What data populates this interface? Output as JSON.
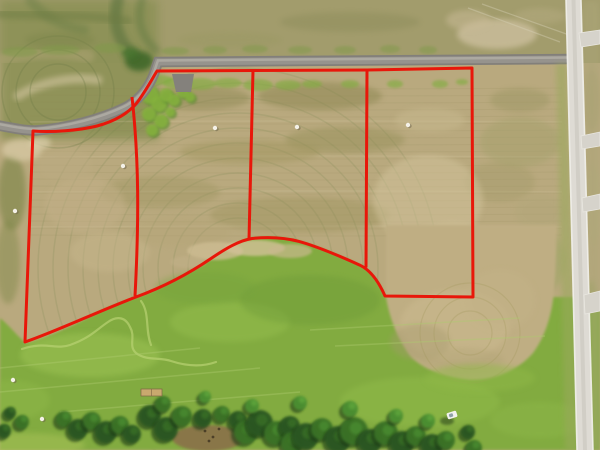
{
  "scene": {
    "type": "aerial-drone-photo",
    "subject": "farmland with four surveyed lots outlined in red, paved road at top, gravel road at right, pasture and tree line below"
  },
  "palette": {
    "field_tan": "#b9a97e",
    "top_strip_olive": "#a29c6c",
    "upper_left_green": "#8c9156",
    "pasture_green": "#82ab40",
    "lobe_tan": "#bfae83",
    "asphalt": "#827f7a",
    "asphalt_mid": "#96938d",
    "asphalt_hi": "#b0ada5",
    "gravel_road": "#dedbd4",
    "gravel_edge": "#f2f1ec",
    "boundary_red": "#e8170a",
    "tree_shadow": "#1b3a15",
    "dirt_brown": "#8a7148"
  },
  "geometry": {
    "base": {
      "w": 600,
      "h": 450,
      "top_strip_h": 63,
      "upper_left": [
        0,
        0,
        158,
        140
      ]
    },
    "pasture_path": "M0,318 C10,326 18,337 26,343 C46,339 82,321 103,310 C121,302 128,300 137,297 C160,289 187,274 209,260 C223,250 236,241 251,238 C268,236 286,237 299,241 C317,246 341,256 360,265 C372,271 380,284 386,297 L600,297 L600,450 L0,450 Z",
    "lobe_path": "M386,297 C389,316 397,339 411,357 C425,370 447,378 470,380 C496,380 518,370 533,353 C545,337 552,315 554,291 C556,268 556,248 557,232 L557,225 L386,225 Z",
    "striations": {
      "y0": 88,
      "y1": 236,
      "step": 7,
      "x0": 30,
      "x1": 562,
      "color": "#8a8157",
      "opacity": 0.13,
      "light_ys": [
        122,
        157,
        192,
        227
      ],
      "light_color": "#d8caa2",
      "light_opacity": 0.22
    },
    "rings": [
      {
        "cx": 238,
        "cy": 268,
        "radii": [
          50,
          65,
          80,
          95,
          110,
          125,
          140,
          155,
          170,
          185,
          200
        ],
        "color": "#77854b",
        "opacity": 0.18
      },
      {
        "cx": 58,
        "cy": 92,
        "radii": [
          28,
          42,
          56
        ],
        "color": "#6d7c46",
        "opacity": 0.3
      },
      {
        "cx": 470,
        "cy": 333,
        "radii": [
          22,
          36,
          50
        ],
        "color": "#a3975c",
        "opacity": 0.3,
        "late": true
      }
    ],
    "ul_strokes": [
      [
        "M118,0 C112,22 118,42 134,55",
        12,
        "#55703a",
        0.55
      ],
      [
        "M142,0 C136,20 142,38 156,50",
        8,
        "#5e7840",
        0.45
      ],
      [
        "M30,0 C45,18 62,26 84,30",
        10,
        "#647a42",
        0.38
      ],
      [
        "M18,96 C40,82 72,76 98,80",
        9,
        "#cfc29b",
        0.65
      ],
      [
        "M0,14 C40,15 92,15 128,21",
        9,
        "#6d7c42",
        0.5
      ],
      [
        "M0,60 C28,52 60,50 88,56",
        13,
        "#b0a476",
        0.5
      ]
    ],
    "field_mottles": [
      [
        200,
        98,
        50,
        12,
        "#8f8a55",
        0.5
      ],
      [
        320,
        96,
        62,
        14,
        "#8a8550",
        0.5
      ],
      [
        345,
        140,
        60,
        13,
        "#938e56",
        0.45
      ],
      [
        250,
        152,
        70,
        12,
        "#9a9157",
        0.38
      ],
      [
        160,
        192,
        60,
        16,
        "#9c945e",
        0.4
      ],
      [
        300,
        215,
        90,
        18,
        "#958e55",
        0.35
      ],
      [
        520,
        100,
        30,
        12,
        "#9a9562",
        0.45
      ],
      [
        500,
        182,
        35,
        20,
        "#a29a68",
        0.4
      ],
      [
        430,
        120,
        35,
        12,
        "#c8b98f",
        0.5
      ],
      [
        85,
        205,
        40,
        28,
        "#c3b088",
        0.5
      ],
      [
        65,
        165,
        28,
        16,
        "#bcab82",
        0.5
      ],
      [
        110,
        252,
        40,
        20,
        "#c8b78d",
        0.45
      ],
      [
        180,
        232,
        50,
        15,
        "#b4a476",
        0.35
      ],
      [
        428,
        200,
        55,
        45,
        "#d3c49c",
        0.5
      ],
      [
        452,
        252,
        45,
        30,
        "#cfc098",
        0.5
      ],
      [
        540,
        212,
        25,
        18,
        "#b0a678",
        0.4
      ],
      [
        520,
        142,
        40,
        25,
        "#a3a06a",
        0.45
      ],
      [
        545,
        262,
        20,
        30,
        "#9aa562",
        0.45
      ],
      [
        12,
        192,
        14,
        38,
        "#73803f",
        0.55
      ],
      [
        8,
        262,
        12,
        42,
        "#7d8746",
        0.45
      ],
      [
        22,
        150,
        20,
        11,
        "#d6c8a2",
        0.8
      ],
      [
        40,
        143,
        11,
        6,
        "#dcd0ac",
        0.7
      ],
      [
        497,
        34,
        40,
        15,
        "#cfc1a0",
        0.75
      ],
      [
        468,
        20,
        22,
        10,
        "#c8b995",
        0.55
      ],
      [
        540,
        16,
        26,
        8,
        "#b5ab80",
        0.5
      ],
      [
        350,
        22,
        70,
        10,
        "#8a8a58",
        0.4
      ],
      [
        230,
        40,
        52,
        8,
        "#989860",
        0.35
      ],
      [
        60,
        40,
        35,
        8,
        "#7a8448",
        0.4
      ],
      [
        592,
        20,
        8,
        18,
        "#a8a271",
        0.55
      ],
      [
        592,
        100,
        8,
        30,
        "#a8a06e",
        0.5
      ],
      [
        594,
        205,
        8,
        40,
        "#b3ab7c",
        0.5
      ],
      [
        591,
        330,
        8,
        50,
        "#8fa055",
        0.5
      ],
      [
        592,
        420,
        8,
        26,
        "#7fa84a",
        0.55
      ],
      [
        139,
        61,
        14,
        10,
        "#3a6527",
        0.85
      ],
      [
        130,
        53,
        8,
        6,
        "#47742e",
        0.8
      ]
    ],
    "bushes": {
      "color": "#86b23d",
      "under": "#5d8c33",
      "blobs": [
        [
          150,
          95,
          9
        ],
        [
          159,
          104,
          8
        ],
        [
          149,
          114,
          7
        ],
        [
          161,
          121,
          7
        ],
        [
          152,
          130,
          6
        ],
        [
          166,
          95,
          7
        ],
        [
          174,
          100,
          6
        ],
        [
          183,
          92,
          6
        ],
        [
          170,
          112,
          5
        ],
        [
          190,
          97,
          5
        ]
      ]
    },
    "strip_under_road": {
      "color": "#83ad42",
      "opacity": 0.65,
      "blobs": [
        [
          160,
          80,
          12,
          5
        ],
        [
          178,
          83,
          15,
          6
        ],
        [
          200,
          84,
          16,
          6
        ],
        [
          228,
          83,
          14,
          5
        ],
        [
          258,
          85,
          15,
          6
        ],
        [
          288,
          85,
          13,
          5
        ],
        [
          312,
          84,
          10,
          4
        ],
        [
          350,
          84,
          9,
          4
        ],
        [
          395,
          84,
          8,
          4
        ],
        [
          440,
          84,
          8,
          4
        ],
        [
          462,
          82,
          6,
          3
        ]
      ]
    },
    "strip_above_road": {
      "color": "#7f9a4a",
      "opacity": 0.5,
      "blobs": [
        [
          20,
          52,
          18,
          5
        ],
        [
          60,
          50,
          20,
          5
        ],
        [
          110,
          48,
          16,
          5
        ],
        [
          175,
          51,
          14,
          4
        ],
        [
          215,
          50,
          12,
          4
        ],
        [
          255,
          49,
          13,
          4
        ],
        [
          300,
          50,
          12,
          4
        ],
        [
          345,
          50,
          11,
          4
        ],
        [
          390,
          49,
          10,
          4
        ],
        [
          428,
          50,
          9,
          4
        ]
      ]
    },
    "pasture_mottles": [
      [
        90,
        355,
        70,
        22,
        "#9ec455",
        0.5
      ],
      [
        230,
        322,
        60,
        20,
        "#97c04f",
        0.45
      ],
      [
        420,
        402,
        80,
        25,
        "#93bd4b",
        0.45
      ],
      [
        540,
        420,
        50,
        18,
        "#8eb848",
        0.45
      ],
      [
        310,
        300,
        70,
        25,
        "#6d9a38",
        0.4
      ],
      [
        205,
        288,
        50,
        16,
        "#74a23c",
        0.35
      ],
      [
        25,
        445,
        60,
        12,
        "#a7c156",
        0.55
      ],
      [
        10,
        400,
        40,
        20,
        "#90b94a",
        0.45
      ],
      [
        480,
        378,
        55,
        14,
        "#8fb846",
        0.5
      ]
    ],
    "sand_crest": [
      [
        215,
        251,
        28,
        9,
        "#cdbc92",
        0.8
      ],
      [
        255,
        248,
        30,
        8,
        "#d2c198",
        0.8
      ],
      [
        290,
        251,
        22,
        7,
        "#c9b88e",
        0.7
      ],
      [
        188,
        262,
        18,
        6,
        "#c2b189",
        0.5
      ]
    ],
    "lobe_mottles": [
      [
        455,
        325,
        55,
        35,
        "#cbb98f",
        0.55
      ],
      [
        500,
        300,
        35,
        30,
        "#c3b287",
        0.5
      ],
      [
        420,
        342,
        30,
        18,
        "#a59a6d",
        0.4
      ],
      [
        462,
        360,
        42,
        12,
        "#b2a577",
        0.45
      ]
    ],
    "trail": {
      "color": "#b8d272",
      "width": 2.2,
      "opacity": 0.7,
      "d1": "M22,349 C45,341 56,350 70,345 C90,338 96,330 108,322 C118,315 126,318 130,327 C136,337 128,346 136,353 C146,361 160,357 171,361 C186,366 202,367 216,362",
      "d2": "M141,301 C150,313 145,330 151,345"
    },
    "tracks": {
      "color": "#aecb6f",
      "opacity": 0.4,
      "width": 1.5,
      "segs": [
        [
          0,
          368,
          200,
          348
        ],
        [
          0,
          392,
          260,
          368
        ],
        [
          60,
          412,
          300,
          392
        ],
        [
          310,
          330,
          520,
          318
        ],
        [
          335,
          346,
          545,
          336
        ]
      ]
    },
    "tracks_top": {
      "color": "#d8d2b8",
      "opacity": 0.4,
      "width": 1.2,
      "segs": [
        [
          468,
          8,
          560,
          42
        ],
        [
          482,
          4,
          572,
          36
        ]
      ]
    },
    "dirt": {
      "x": 208,
      "y": 438,
      "rx": 36,
      "ry": 13,
      "specks": [
        [
          205,
          431
        ],
        [
          213,
          437
        ],
        [
          219,
          429
        ],
        [
          209,
          441
        ]
      ]
    },
    "trees": {
      "colors": [
        "#1b3a15",
        "#2c5620",
        "#3b7228",
        "#4c8f33",
        "#61a83e"
      ],
      "blobs": [
        [
          10,
          413,
          6,
          1
        ],
        [
          22,
          422,
          7,
          2
        ],
        [
          4,
          431,
          7,
          1
        ],
        [
          64,
          419,
          8,
          2
        ],
        [
          78,
          429,
          10,
          1
        ],
        [
          92,
          421,
          9,
          2
        ],
        [
          106,
          432,
          11,
          1
        ],
        [
          120,
          425,
          9,
          2
        ],
        [
          132,
          434,
          9,
          1
        ],
        [
          150,
          416,
          11,
          1
        ],
        [
          163,
          404,
          8,
          2
        ],
        [
          166,
          429,
          12,
          1
        ],
        [
          182,
          416,
          10,
          2
        ],
        [
          203,
          418,
          9,
          1
        ],
        [
          222,
          414,
          8,
          2
        ],
        [
          238,
          420,
          9,
          1
        ],
        [
          246,
          432,
          12,
          2
        ],
        [
          260,
          423,
          13,
          1
        ],
        [
          276,
          433,
          12,
          2
        ],
        [
          290,
          426,
          10,
          1
        ],
        [
          292,
          443,
          11,
          2
        ],
        [
          306,
          436,
          13,
          1
        ],
        [
          322,
          429,
          11,
          2
        ],
        [
          338,
          439,
          13,
          1
        ],
        [
          354,
          431,
          14,
          2
        ],
        [
          370,
          441,
          12,
          1
        ],
        [
          386,
          433,
          12,
          2
        ],
        [
          402,
          443,
          12,
          1
        ],
        [
          416,
          436,
          10,
          2
        ],
        [
          432,
          445,
          11,
          1
        ],
        [
          446,
          440,
          9,
          2
        ],
        [
          468,
          432,
          7,
          1
        ],
        [
          474,
          448,
          8,
          2
        ],
        [
          205,
          397,
          6,
          3
        ],
        [
          252,
          406,
          7,
          3
        ],
        [
          300,
          403,
          7,
          3
        ],
        [
          350,
          409,
          8,
          3
        ],
        [
          396,
          416,
          7,
          3
        ],
        [
          428,
          421,
          7,
          3
        ]
      ]
    },
    "roads": {
      "asphalt_d": "M-4,125 C12,128 24,130.5 36,130.5 C68,128 101,119 124,108 C139,100.5 148.5,88 154,74 C156,68 157,64.5 158,62 L574,59",
      "asphalt_hi_d": "M-4,123.5 C12,126.5 24,129 36,129 C68,126.5 101,117.5 124,106.5 C139,99 148.5,86.5 154,72.5 C156,66.5 157,63 158,60.5 L574,57.5",
      "driveway_pts": "172,74 194,74 191,92 176,92",
      "shoulder_pts": "556,64 567,64 579,450 565,450",
      "east_sliver_pts": "581,0 600,0 600,450 592,450",
      "right_poly": "566,0 581,0 593,450 577,450",
      "right_edges": [
        [
          566,
          0,
          577,
          450
        ],
        [
          581,
          0,
          593,
          450
        ]
      ],
      "right_center": [
        573.5,
        0,
        585,
        450
      ],
      "stubs": [
        "579,33 600,30 600,44 581,47",
        "581,136 600,132 600,146 582,149",
        "582,198 600,194 600,209 583,212",
        "584,295 600,291 600,311 585,314"
      ]
    },
    "markers": [
      [
        123,
        166
      ],
      [
        215,
        128
      ],
      [
        297,
        127
      ],
      [
        408,
        125
      ],
      [
        13,
        380
      ],
      [
        42,
        419
      ],
      [
        15,
        211
      ]
    ],
    "vehicle": {
      "x": 452,
      "y": 415,
      "w": 10,
      "h": 6.5,
      "angle": -18,
      "body": "#f2f2ee",
      "glass": "#8fa0a8"
    },
    "structure": {
      "x": 141,
      "y": 389,
      "w": 21,
      "h": 7,
      "fill": "#c9a96e",
      "stroke": "#7c6743"
    },
    "boundary": {
      "color": "#e8170a",
      "width": 3,
      "outline": "M472,68 L367,70 L253,70.5 L157,71 C152,79 148,87 139,100 C130,113 114,121.5 97,126 C79,130.5 52,132.5 33,131 L25,342 C56,331.5 99,311 136,297 C162,287.5 189,273.5 211,258.5 C225,249 239,240.5 252,238.5 C268,236.8 285,237.8 299,241.4 C317,246.3 341,256.6 360,265.2 C371,270.5 379.5,283.5 385,296 L473,297 Z",
      "dividers": [
        "M132,97 C139,160 139,220 135,296",
        "M253,70.5 L249,240",
        "M367,70 L366,267.5"
      ]
    }
  }
}
